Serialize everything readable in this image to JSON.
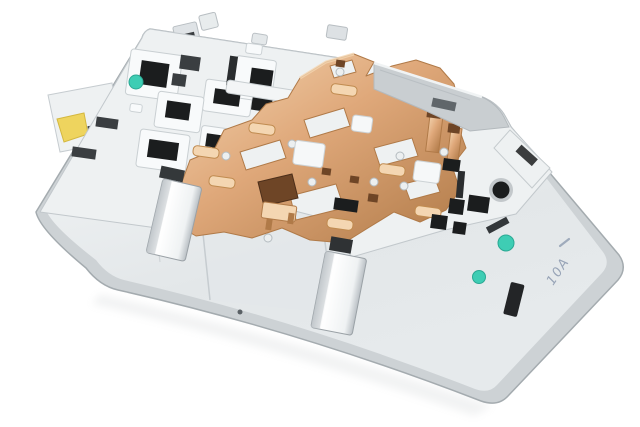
{
  "image": {
    "type": "product-photo",
    "subject": "Automotive interior dome-light / switch module, rear view",
    "description": "Rear side of a light-grey plastic car interior light module tilted diagonally on a plain white background, showing stamped copper busbar circuitry, black connector socket openings, two bright metal spring clips, a round black hole, teal paint inspection dots, a yellow clip and a faint handwritten pen marking on the smooth side face.",
    "marking": {
      "text": "10A",
      "style": "handwritten pen, rotated on side face"
    },
    "paint_dots": [
      {
        "name": "teal-dot-top-left"
      },
      {
        "name": "teal-dot-right-upper"
      },
      {
        "name": "teal-dot-right-lower"
      }
    ],
    "colors": {
      "background": "#ffffff",
      "plastic_light": "#eef1f2",
      "plastic_mid": "#e3e7e9",
      "plastic_grey": "#c9ced1",
      "plastic_shadow": "#a4abaf",
      "rim_band": "#cdd2d5",
      "body_light": "#f8fafb",
      "body_deep": "#e6eaec",
      "slot_black": "#1b1d1e",
      "slot_grey": "#3a3e41",
      "copper": "#dfa87a",
      "copper_light": "#f4d6b2",
      "copper_deep": "#b07a48",
      "copper_contact": "#6e4526",
      "metal_light": "#ffffff",
      "metal_mid": "#eff2f3",
      "metal_dark": "#b9bfc4",
      "teal": "#3ecdb4",
      "teal_deep": "#2aa893",
      "yellow": "#eed45e",
      "yellow_deep": "#d4b83f",
      "pen": "#5a6d8e"
    }
  }
}
